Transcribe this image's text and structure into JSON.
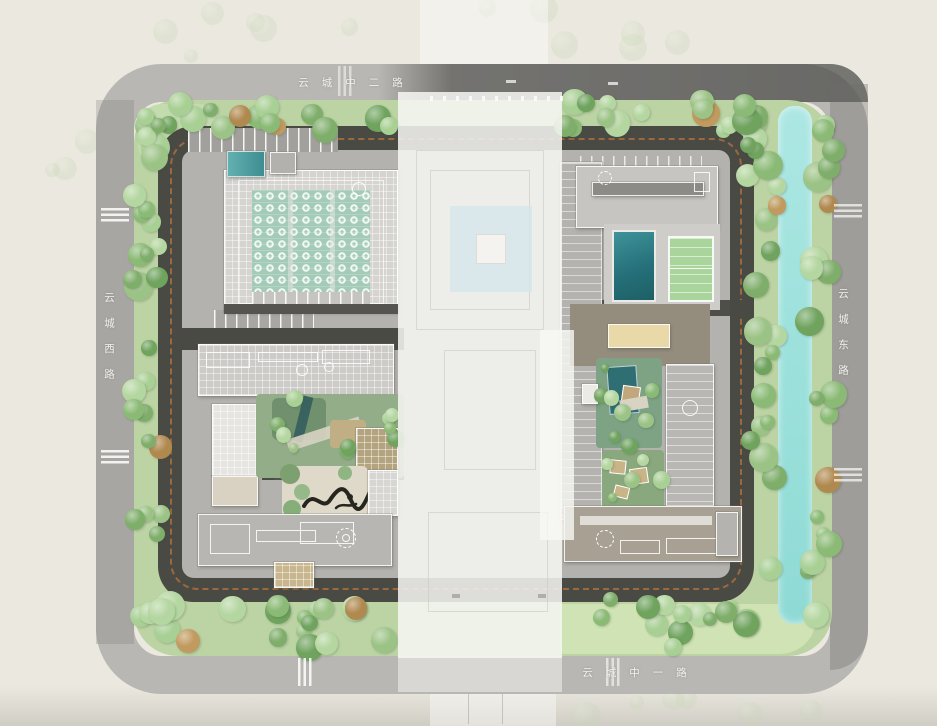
{
  "map": {
    "type": "residential-master-plan",
    "roads": {
      "top": {
        "label": "云城中二路"
      },
      "bottom": {
        "label": "云城中一路"
      },
      "left": {
        "label": "云城西路"
      },
      "right": {
        "label": "云城东路"
      }
    }
  },
  "palette": {
    "background": "#ebe9df",
    "outer_road": "#b9b7b3",
    "outer_road_dark": "#6f6f6d",
    "inner_road": "#4a4a45",
    "paving": "#b4b2ae",
    "greenbelt": "#bcd3a4",
    "lawn": "#cfe3b4",
    "canal": "#9fe2dd",
    "pool": "#26707a",
    "sports_court": "#a9d49c",
    "roof_garden": "#a3cbb8",
    "building_light": "#d6d4d0",
    "building_white": "#e7e5e1",
    "building_tan": "#c8b68e",
    "podium_taupe": "#948d7d",
    "fire_lane": "#c0763a",
    "road_label_text": "#f2f1ee",
    "tree_greens": [
      "#9cc386",
      "#8aba75",
      "#a8cf94",
      "#7fae6b",
      "#b4d6a0",
      "#6fa35e"
    ],
    "tree_accent": [
      "#b0894f",
      "#c09a5e"
    ]
  }
}
